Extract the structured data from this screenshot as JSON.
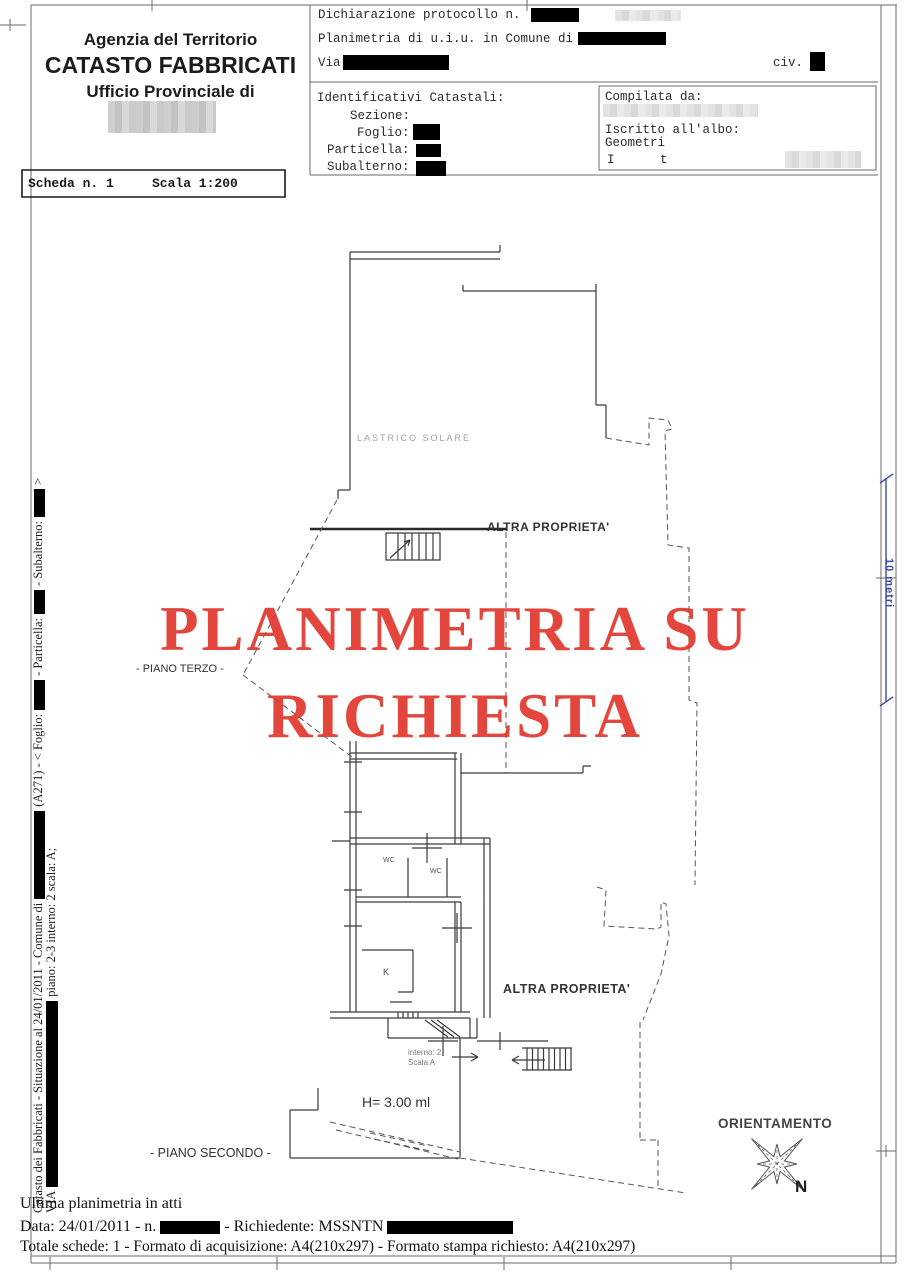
{
  "header": {
    "agency": {
      "line1": "Agenzia del Territorio",
      "line2": "CATASTO FABBRICATI",
      "line3": "Ufficio Provinciale di"
    },
    "declaration": {
      "protocol": "Dichiarazione protocollo n.",
      "planimetria": "Planimetria di u.i.u. in Comune di",
      "via": "Via",
      "civ": "civ."
    },
    "identifiers": {
      "title": "Identificativi Catastali:",
      "sezione": "Sezione:",
      "foglio": "Foglio:",
      "particella": "Particella:",
      "subalterno": "Subalterno:"
    },
    "compiler": {
      "title": "Compilata da:",
      "albo1": "Iscritto all'albo:",
      "albo2": "Geometri",
      "frag1": "I",
      "frag2": "t"
    },
    "scheda": {
      "number": "Scheda n. 1",
      "scale": "Scala 1:200"
    }
  },
  "watermark": {
    "line1": "PLANIMETRIA SU",
    "line2": "RICHIESTA",
    "color": "#e0392e"
  },
  "plan": {
    "lastrico": "LASTRICO SOLARE",
    "altra_top": "ALTRA PROPRIETA'",
    "piano_terzo": "- PIANO TERZO -",
    "wc1": "WC",
    "wc2": "WC",
    "kitchen": "K",
    "altra_bottom": "ALTRA PROPRIETA'",
    "interno": "interno: 2",
    "scala_a": "Scala A",
    "height": "H= 3.00 ml",
    "piano_secondo": "- PIANO SECONDO -"
  },
  "scalebar": {
    "label": "10 metri",
    "color": "#3a4da0"
  },
  "orientation": {
    "title": "ORIENTAMENTO",
    "north": "N"
  },
  "sidebar": {
    "outer": {
      "s1": "Catasto dei Fabbricati - Situazione al 24/01/2011 - Comune di",
      "s2": "(A271) - < Foglio:",
      "s3": "- Particella:",
      "s4": "- Subalterno:",
      "s5": ">"
    },
    "inner": {
      "s1": "VIA",
      "s2": "piano: 2-3 interno: 2 scala: A;"
    }
  },
  "footer": {
    "line1": "Ultima planimetria in atti",
    "line2a": "Data: 24/01/2011 - n.",
    "line2b": "- Richiedente: MSSNTN",
    "line3": "Totale schede: 1 - Formato di acquisizione: A4(210x297) - Formato stampa richiesto: A4(210x297)"
  }
}
